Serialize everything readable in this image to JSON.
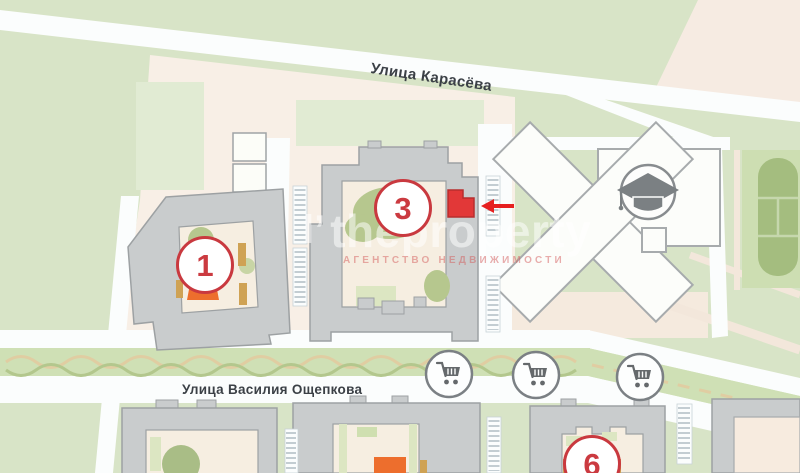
{
  "map_title": "residential complex map",
  "streets": [
    {
      "name": "Улица Карасёва"
    },
    {
      "name": "Улица Василия Ощепкова"
    }
  ],
  "buildings": [
    {
      "marker": "1"
    },
    {
      "marker": "3"
    },
    {
      "marker": "6"
    }
  ],
  "highlight": {
    "label": "selected unit in building 3",
    "color": "#e23838",
    "arrow_color": "#e62020"
  },
  "poi": {
    "school_icon": "graduation-cap",
    "store_icon": "shopping-cart",
    "store_count": 3
  },
  "watermark": {
    "logo": "l’",
    "title": "theproperty",
    "subtitle": "АГЕНТСТВО НЕДВИЖИМОСТИ"
  },
  "colors": {
    "ground_green": "#d8e4c7",
    "block_peach": "#f8efe6",
    "road_white": "#fbfdfd",
    "building_gray": "#c9cccd",
    "building_outline": "#9da1a3",
    "courtyard_cream": "#f6eee1",
    "tree_green": "#b6c78e",
    "playground_orange": "#ed6e2d",
    "marker_red": "#c9393f",
    "sports_field_green": "#a4bd7f"
  }
}
